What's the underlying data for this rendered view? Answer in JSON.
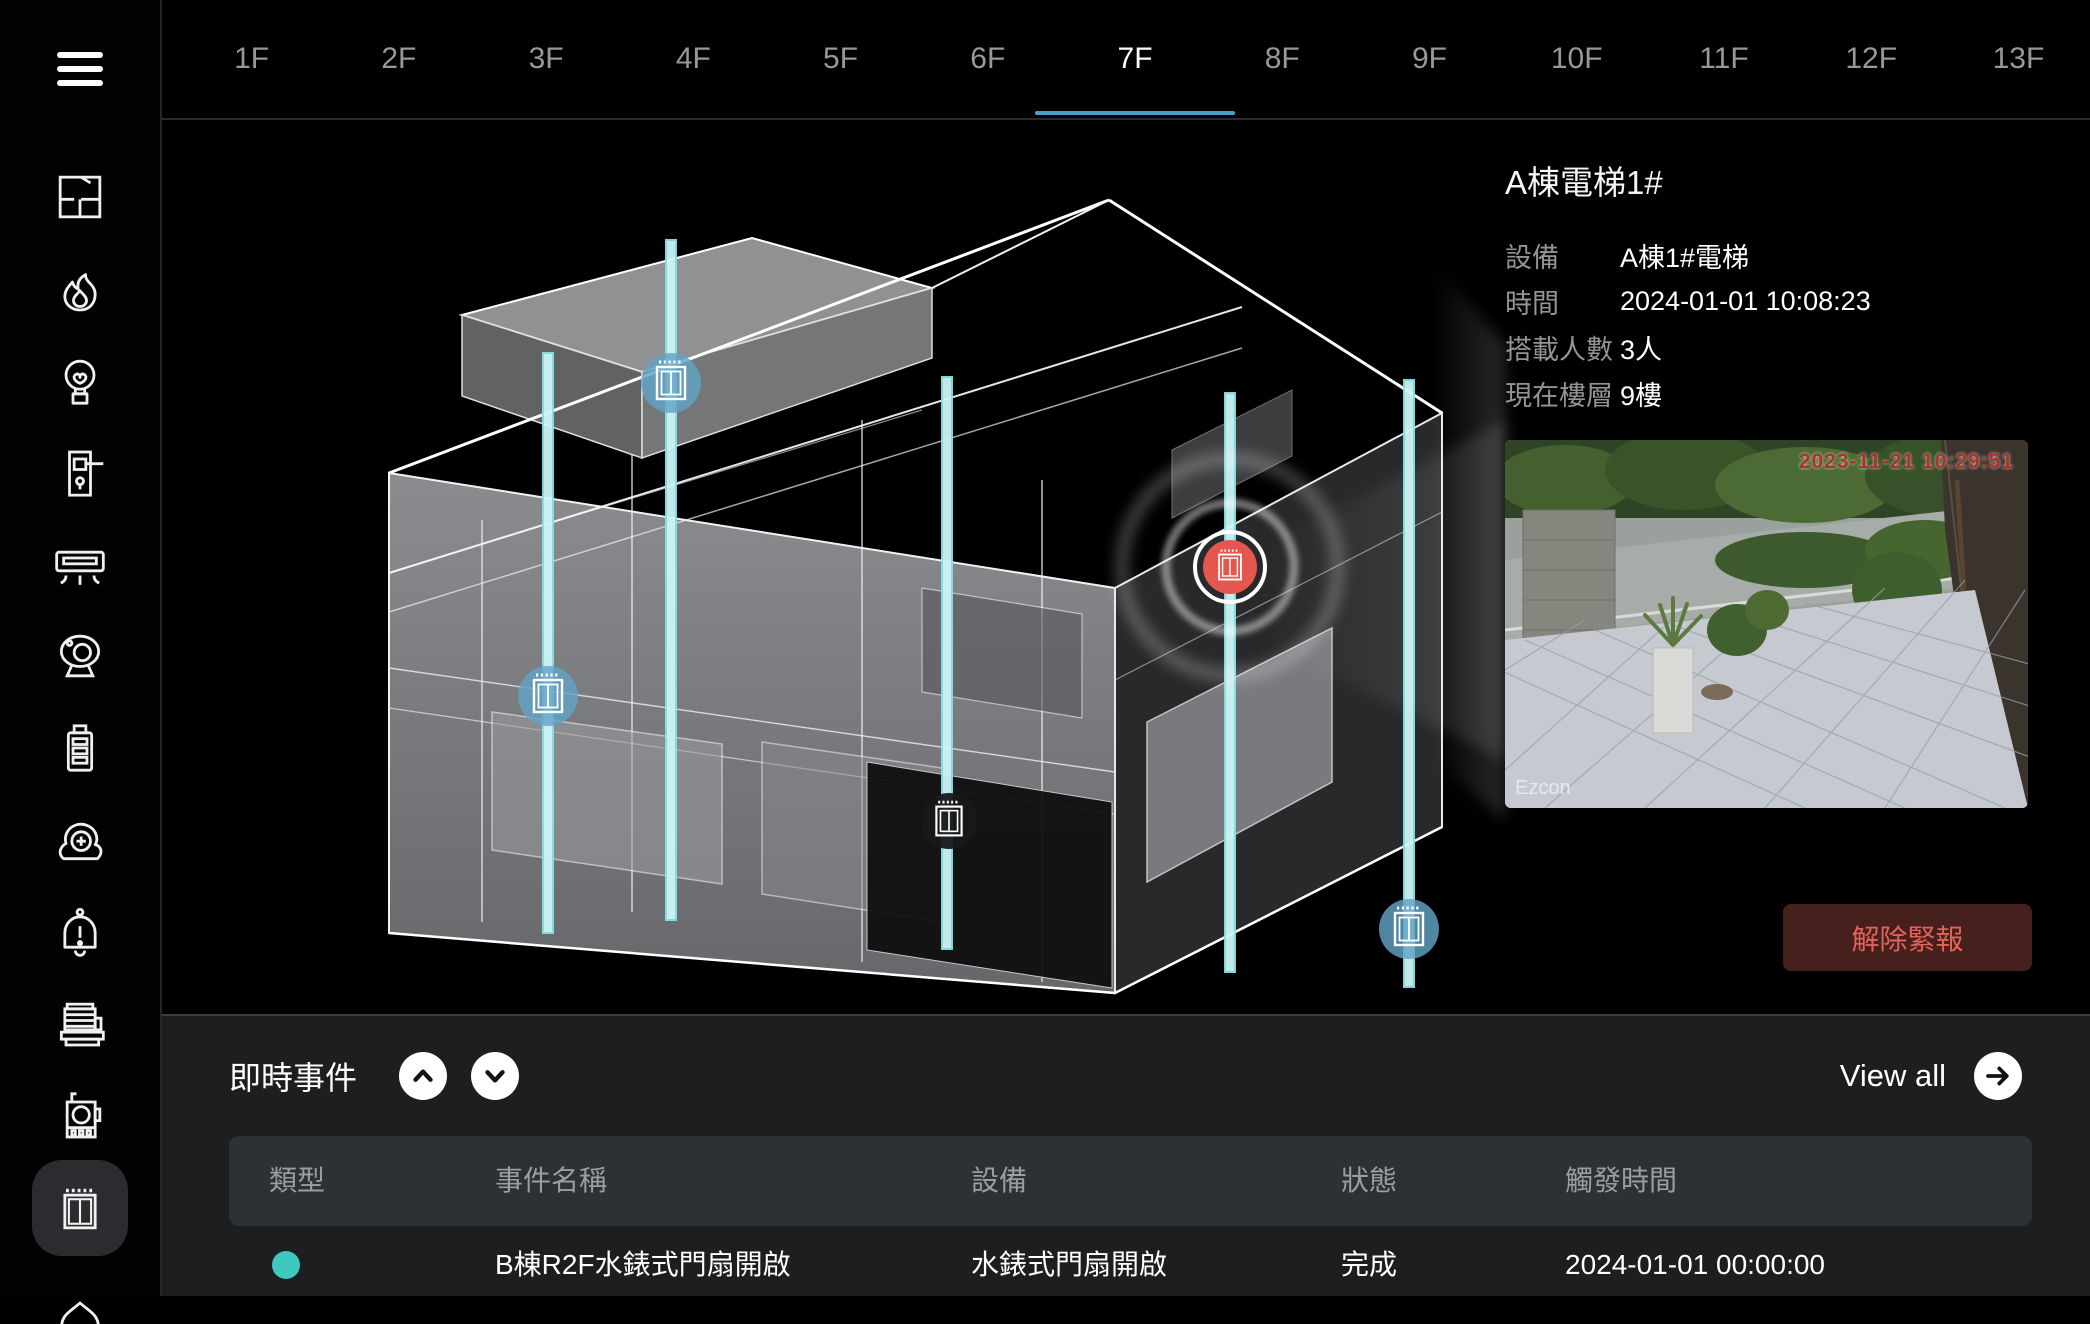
{
  "sidebar": {
    "menu_icon": "hamburger-menu",
    "items": [
      {
        "id": "floors",
        "icon": "floor-plan-icon",
        "selected": false
      },
      {
        "id": "fire",
        "icon": "fire-icon",
        "selected": false
      },
      {
        "id": "lighting",
        "icon": "light-bulb-icon",
        "selected": false
      },
      {
        "id": "door-access",
        "icon": "door-lock-icon",
        "selected": false
      },
      {
        "id": "hvac",
        "icon": "air-conditioner-icon",
        "selected": false
      },
      {
        "id": "cctv",
        "icon": "camera-icon",
        "selected": false
      },
      {
        "id": "power",
        "icon": "battery-icon",
        "selected": false
      },
      {
        "id": "pump",
        "icon": "fan-pump-icon",
        "selected": false
      },
      {
        "id": "alarm",
        "icon": "alarm-bell-icon",
        "selected": false
      },
      {
        "id": "generator",
        "icon": "generator-icon",
        "selected": false
      },
      {
        "id": "water-meter",
        "icon": "meter-icon",
        "selected": false
      },
      {
        "id": "elevator",
        "icon": "elevator-icon",
        "selected": true
      },
      {
        "id": "security",
        "icon": "shield-icon",
        "selected": false
      }
    ]
  },
  "floor_tabs": {
    "active": "7F",
    "tabs": [
      "1F",
      "2F",
      "3F",
      "4F",
      "5F",
      "6F",
      "7F",
      "8F",
      "9F",
      "10F",
      "11F",
      "12F",
      "13F"
    ]
  },
  "detail_panel": {
    "title": "A棟電梯1#",
    "rows": [
      {
        "label": "設備",
        "value": "A棟1#電梯"
      },
      {
        "label": "時間",
        "value": "2024-01-01 10:08:23"
      },
      {
        "label": "搭載人數",
        "value": "3人"
      },
      {
        "label": "現在樓層",
        "value": "9樓"
      }
    ],
    "camera": {
      "timestamp": "2023-11-21 10:29:51",
      "watermark": "Ezcon"
    },
    "alarm_button_label": "解除緊報"
  },
  "events": {
    "title": "即時事件",
    "view_all_label": "View all",
    "columns": [
      "類型",
      "事件名稱",
      "設備",
      "狀態",
      "觸發時間"
    ],
    "rows": [
      {
        "type_color": "#3fc8bd",
        "name": "B棟R2F水錶式門扇開啟",
        "device": "水錶式門扇開啟",
        "status": "完成",
        "time": "2024-01-01 00:00:00"
      }
    ]
  },
  "colors": {
    "accent_blue": "#4d9fc9",
    "shaft_cyan": "#9ae9ec",
    "marker_blue": "#63a3c6",
    "marker_alert_red": "#e4574e",
    "alarm_button_bg": "#45201d",
    "alarm_button_text": "#e4625a",
    "event_dot_teal": "#3fc8bd",
    "events_panel_bg": "#1c1e20",
    "table_header_bg": "#2d3034"
  }
}
